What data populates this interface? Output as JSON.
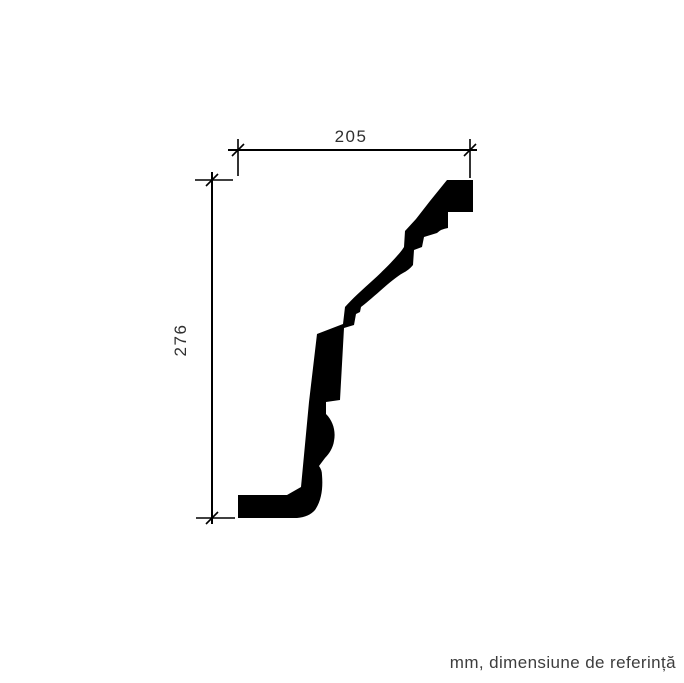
{
  "drawing": {
    "title": "cornice-profile-technical-drawing",
    "horizontal_dimension": {
      "value": "205"
    },
    "vertical_dimension": {
      "value": "276"
    },
    "units_note": "mm, dimensiune de referință",
    "colors": {
      "ink": "#000000",
      "label": "#2f2f2f",
      "footnote": "#3d3d3d",
      "background": "#ffffff"
    }
  }
}
